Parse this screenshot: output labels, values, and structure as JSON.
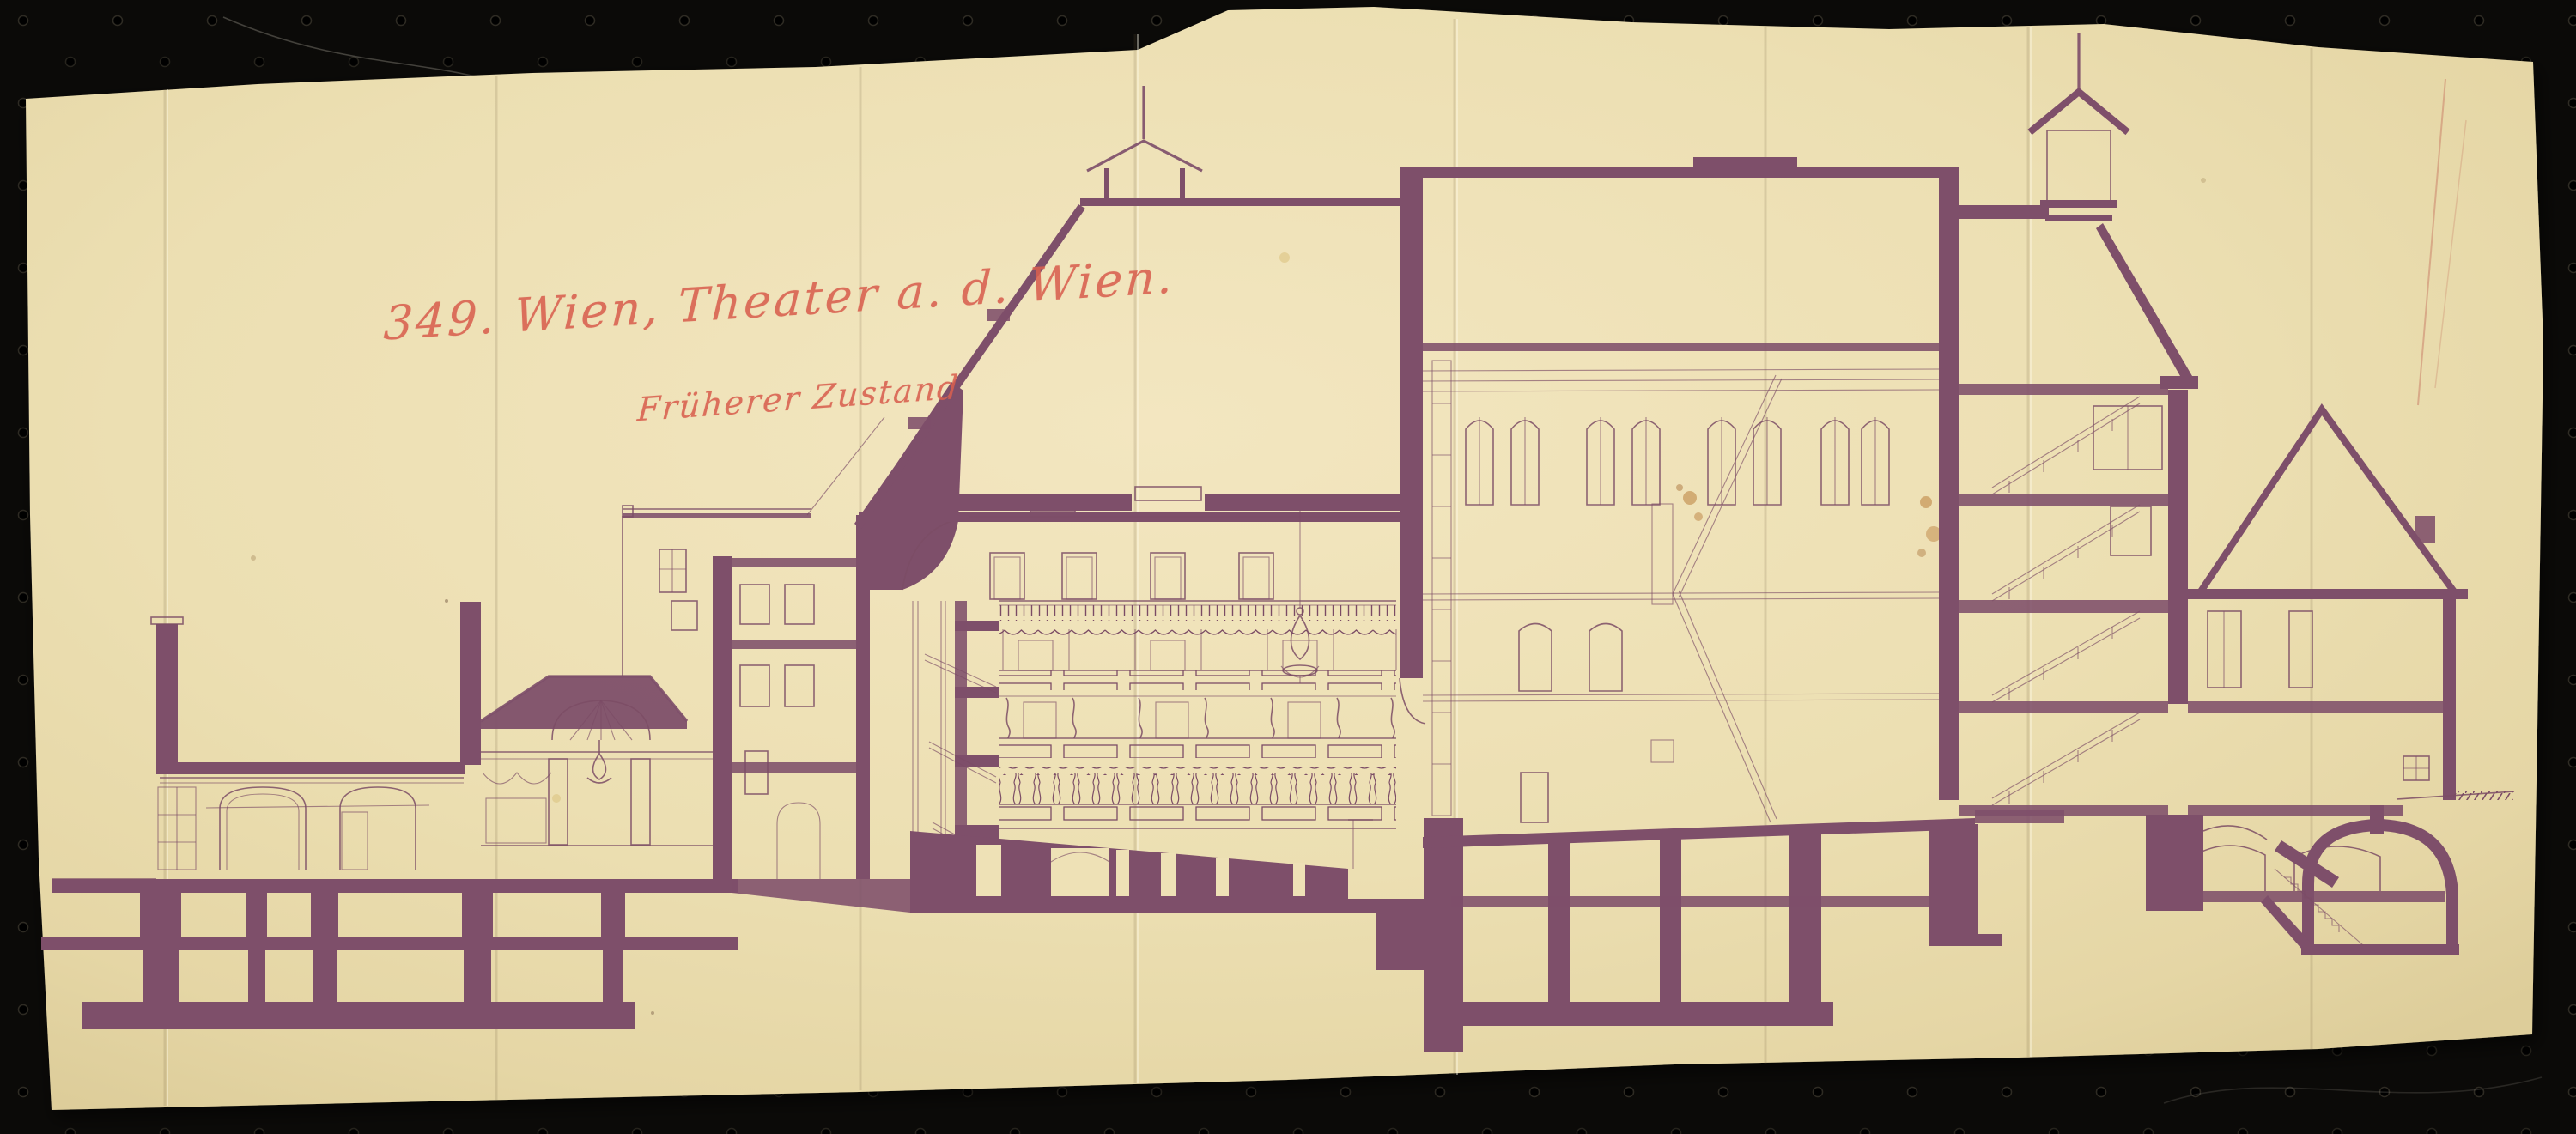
{
  "scan": {
    "board_color": "#0b0a08",
    "paper_color": "#eee1b6",
    "ink_color": "#7e4f6a",
    "line_color": "#7b4c65",
    "annotation_color": "#d9604f"
  },
  "annotations": {
    "catalog_title": "349. Wien, Theater a. d. Wien.",
    "state_note": "Früherer Zustand"
  }
}
